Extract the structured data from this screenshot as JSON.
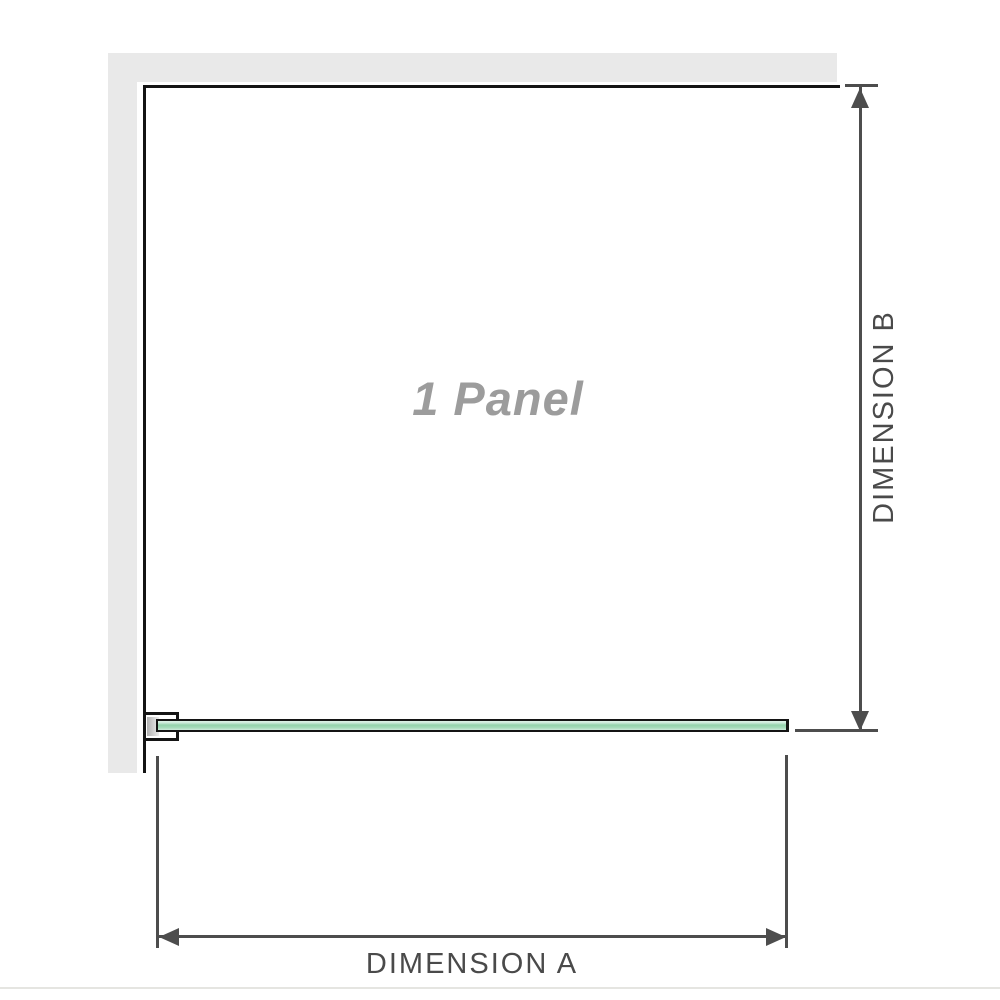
{
  "diagram": {
    "panel_label": "1 Panel",
    "dimension_a": {
      "label": "DIMENSION A"
    },
    "dimension_b": {
      "label": "DIMENSION B"
    },
    "colors": {
      "wall": "#e9e9e9",
      "frame_outline": "#141414",
      "glass_green_light": "#dff2e7",
      "glass_green_mid": "#94d2ac",
      "bracket_insert_gray": "#b2b2b2",
      "dimension_line": "#4d4d4d",
      "dimension_text": "#4a4a4a",
      "panel_label_text": "#9c9c9c",
      "floor_line": "#e5e5e1",
      "background": "#ffffff"
    }
  }
}
